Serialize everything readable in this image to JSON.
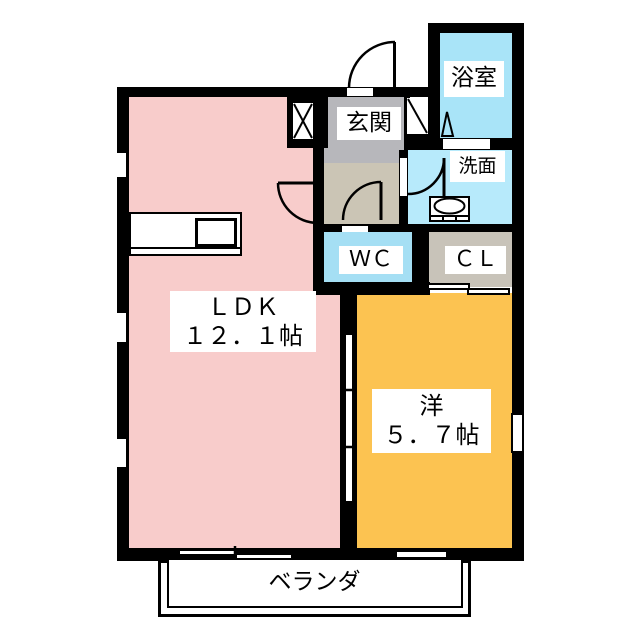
{
  "plan": {
    "ldk": {
      "name_label": "ＬＤＫ",
      "size_label": "１２．１帖"
    },
    "western_room": {
      "name_label": "洋",
      "size_label": "５．７帖"
    },
    "entrance": {
      "label": "玄関"
    },
    "bathroom": {
      "label": "浴室"
    },
    "washroom": {
      "label": "洗面"
    },
    "toilet": {
      "label": "ＷＣ"
    },
    "closet": {
      "label": "ＣＬ"
    },
    "veranda": {
      "label": "ベランダ"
    }
  },
  "colors": {
    "ldk": "#f8cccb",
    "western_room": "#fcc351",
    "bathroom": "#a9e4f8",
    "washroom": "#b7eafb",
    "toilet": "#a5dff4",
    "entrance": "#b7b7bb",
    "hallway": "#cbc5b5",
    "closet": "#c8c3b9",
    "wall": "#000000",
    "background": "#ffffff"
  }
}
